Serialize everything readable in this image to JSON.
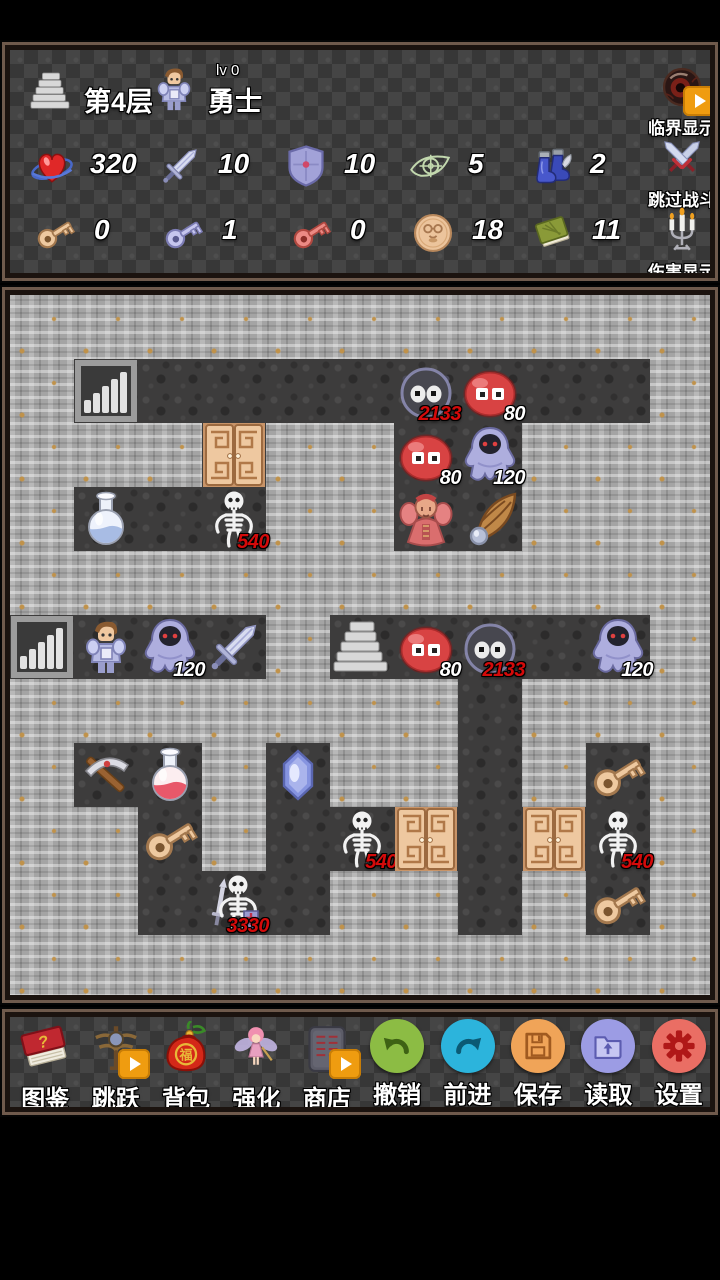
{
  "colors": {
    "accent_orange": "#EF9C10",
    "damage_red": "#D40A0A",
    "damage_white": "#FFFFFF"
  },
  "hud": {
    "floor_label": "第4层",
    "hero": {
      "level_label": "lv 0",
      "name": "勇士"
    },
    "stats": [
      {
        "name": "hp",
        "value": "320"
      },
      {
        "name": "attack",
        "value": "10"
      },
      {
        "name": "defense",
        "value": "10"
      },
      {
        "name": "vision",
        "value": "5"
      },
      {
        "name": "boots",
        "value": "2"
      }
    ],
    "inventory": [
      {
        "name": "yellow-key",
        "value": "0"
      },
      {
        "name": "blue-key",
        "value": "1"
      },
      {
        "name": "red-key",
        "value": "0"
      },
      {
        "name": "medal",
        "value": "18"
      },
      {
        "name": "book",
        "value": "11"
      }
    ],
    "toggles": [
      {
        "name": "critical-display",
        "label": "临界显示",
        "badge": true
      },
      {
        "name": "skip-battle",
        "label": "跳过战斗",
        "badge": false
      },
      {
        "name": "damage-display",
        "label": "伤害显示",
        "badge": false
      }
    ]
  },
  "map": {
    "grid": [
      "###########",
      "#.........#",
      "###.##..###",
      "#...##..###",
      "###########",
      "....#.....#",
      "#######.###",
      "#..#.##.#.#",
      "##.#......#",
      "##...##.#.#",
      "###########"
    ],
    "entities": [
      {
        "sprite": "stairs-up",
        "row": 1,
        "col": 1
      },
      {
        "sprite": "bat",
        "row": 1,
        "col": 6,
        "label": "2133",
        "label_color": "red"
      },
      {
        "sprite": "slime",
        "row": 1,
        "col": 7,
        "label": "80",
        "label_color": "white"
      },
      {
        "sprite": "door",
        "row": 2,
        "col": 3
      },
      {
        "sprite": "slime",
        "row": 2,
        "col": 6,
        "label": "80",
        "label_color": "white"
      },
      {
        "sprite": "ghost",
        "row": 2,
        "col": 7,
        "label": "120",
        "label_color": "white"
      },
      {
        "sprite": "potion-blue",
        "row": 3,
        "col": 1
      },
      {
        "sprite": "skeleton",
        "row": 3,
        "col": 3,
        "label": "540",
        "label_color": "red"
      },
      {
        "sprite": "priest",
        "row": 3,
        "col": 6
      },
      {
        "sprite": "wing",
        "row": 3,
        "col": 7
      },
      {
        "sprite": "stairs-up",
        "row": 5,
        "col": 0
      },
      {
        "sprite": "hero",
        "row": 5,
        "col": 1
      },
      {
        "sprite": "ghost",
        "row": 5,
        "col": 2,
        "label": "120",
        "label_color": "white"
      },
      {
        "sprite": "sword",
        "row": 5,
        "col": 3
      },
      {
        "sprite": "stairs-down",
        "row": 5,
        "col": 5
      },
      {
        "sprite": "slime",
        "row": 5,
        "col": 6,
        "label": "80",
        "label_color": "white"
      },
      {
        "sprite": "bat",
        "row": 5,
        "col": 7,
        "label": "2133",
        "label_color": "red"
      },
      {
        "sprite": "ghost",
        "row": 5,
        "col": 9,
        "label": "120",
        "label_color": "white"
      },
      {
        "sprite": "pickaxe",
        "row": 7,
        "col": 1
      },
      {
        "sprite": "potion-red",
        "row": 7,
        "col": 2
      },
      {
        "sprite": "gem",
        "row": 7,
        "col": 4
      },
      {
        "sprite": "key-yellow",
        "row": 7,
        "col": 9
      },
      {
        "sprite": "key-yellow",
        "row": 8,
        "col": 2
      },
      {
        "sprite": "skeleton",
        "row": 8,
        "col": 5,
        "label": "540",
        "label_color": "red"
      },
      {
        "sprite": "door",
        "row": 8,
        "col": 6
      },
      {
        "sprite": "door",
        "row": 8,
        "col": 8
      },
      {
        "sprite": "skeleton",
        "row": 8,
        "col": 9,
        "label": "540",
        "label_color": "red"
      },
      {
        "sprite": "skeleton-warrior",
        "row": 9,
        "col": 3,
        "label": "3330",
        "label_color": "red"
      },
      {
        "sprite": "key-yellow",
        "row": 9,
        "col": 9
      }
    ]
  },
  "toolbar": {
    "items": [
      {
        "name": "guide",
        "label": "图鉴",
        "badge": false
      },
      {
        "name": "jump",
        "label": "跳跃",
        "badge": true
      },
      {
        "name": "bag",
        "label": "背包",
        "badge": false
      },
      {
        "name": "enhance",
        "label": "强化",
        "badge": false
      },
      {
        "name": "shop",
        "label": "商店",
        "badge": true
      },
      {
        "name": "undo",
        "label": "撤销",
        "badge": false
      },
      {
        "name": "redo",
        "label": "前进",
        "badge": false
      },
      {
        "name": "save",
        "label": "保存",
        "badge": false
      },
      {
        "name": "load",
        "label": "读取",
        "badge": false
      },
      {
        "name": "settings",
        "label": "设置",
        "badge": false
      }
    ]
  }
}
